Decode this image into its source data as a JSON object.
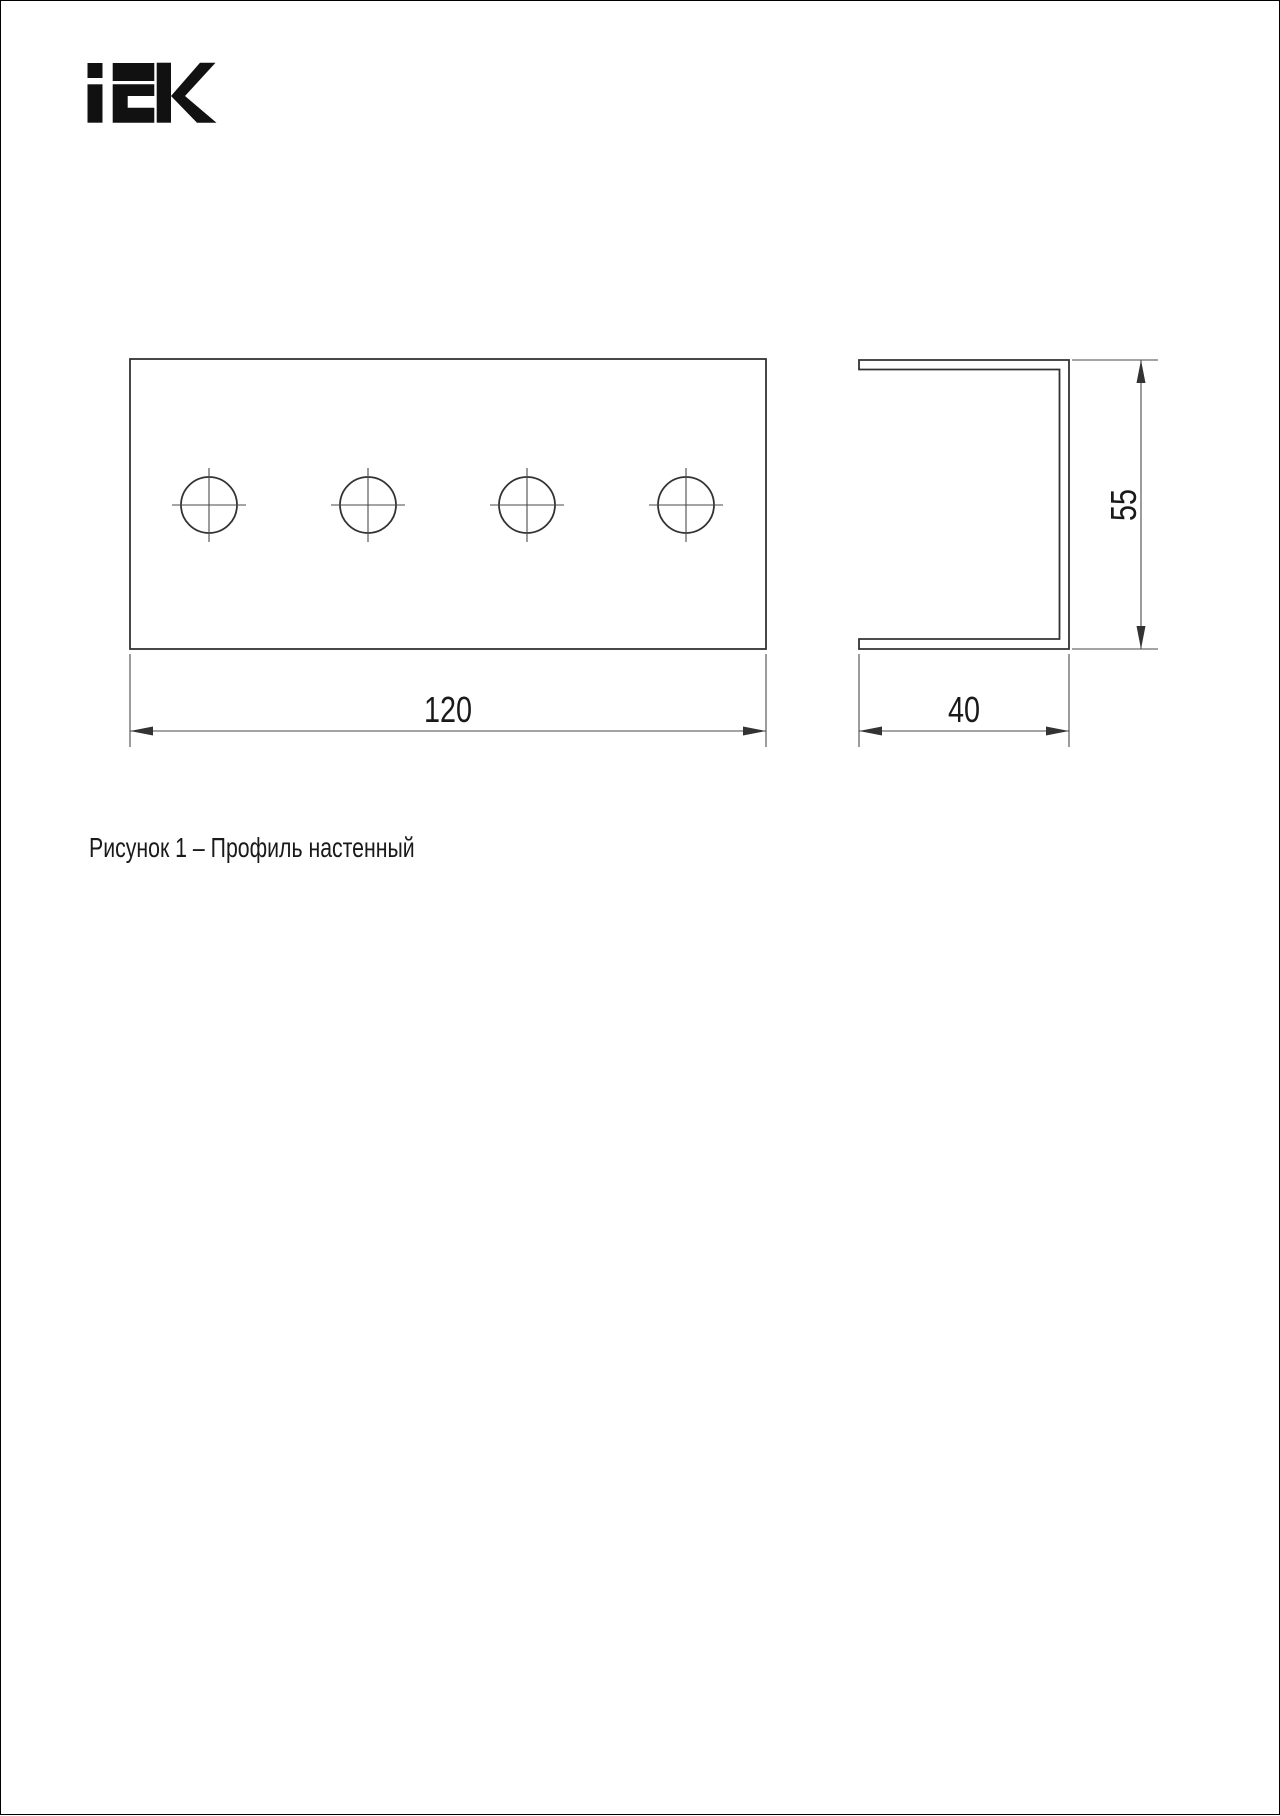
{
  "logo": {
    "text": "IEK"
  },
  "figure": {
    "caption": "Рисунок 1 – Профиль настенный"
  },
  "drawing": {
    "front_view": {
      "width_label": "120",
      "holes": 4
    },
    "side_view": {
      "width_label": "40",
      "height_label": "55"
    }
  },
  "colors": {
    "line-main": "#333333",
    "line-thin": "#4a4a4a",
    "text": "#1a1a1a",
    "logo": "#111111",
    "page-border": "#000000"
  }
}
